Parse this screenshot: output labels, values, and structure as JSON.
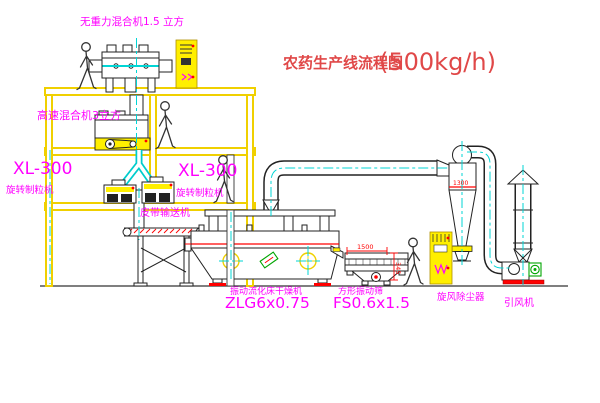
{
  "title": {
    "main": "农药生产线流程图",
    "capacity": "(500kg/h)"
  },
  "equipment_labels": {
    "zero_gravity_mixer": "无重力混合机1.5 立方",
    "high_speed_mixer": "高速混合机3立方",
    "granulator_left_model": "XL-300",
    "granulator_left_name": "旋转制粒机",
    "granulator_right_model": "XL-300",
    "granulator_right_name": "旋转制粒机",
    "belt_conveyor": "皮带输送机",
    "fluid_bed_dryer_name": "振动流化床干燥机",
    "fluid_bed_dryer_model": "ZLG6x0.75",
    "square_sieve_name": "方形振动筛",
    "square_sieve_model": "FS0.6x1.5",
    "cyclone_dust_collector": "旋风除尘器",
    "induced_draft_fan": "引风机"
  },
  "dimensions": {
    "sieve_length": "1500",
    "sieve_height": "345",
    "cyclone_inlet": "1300"
  },
  "colors": {
    "frame_yellow": "#f0d000",
    "fill_yellow": "#ffef00",
    "label_magenta": "#ff00ff",
    "title_red": "#e04848",
    "dimension_red": "#ff0000",
    "centerline_cyan": "#00d5d5"
  }
}
